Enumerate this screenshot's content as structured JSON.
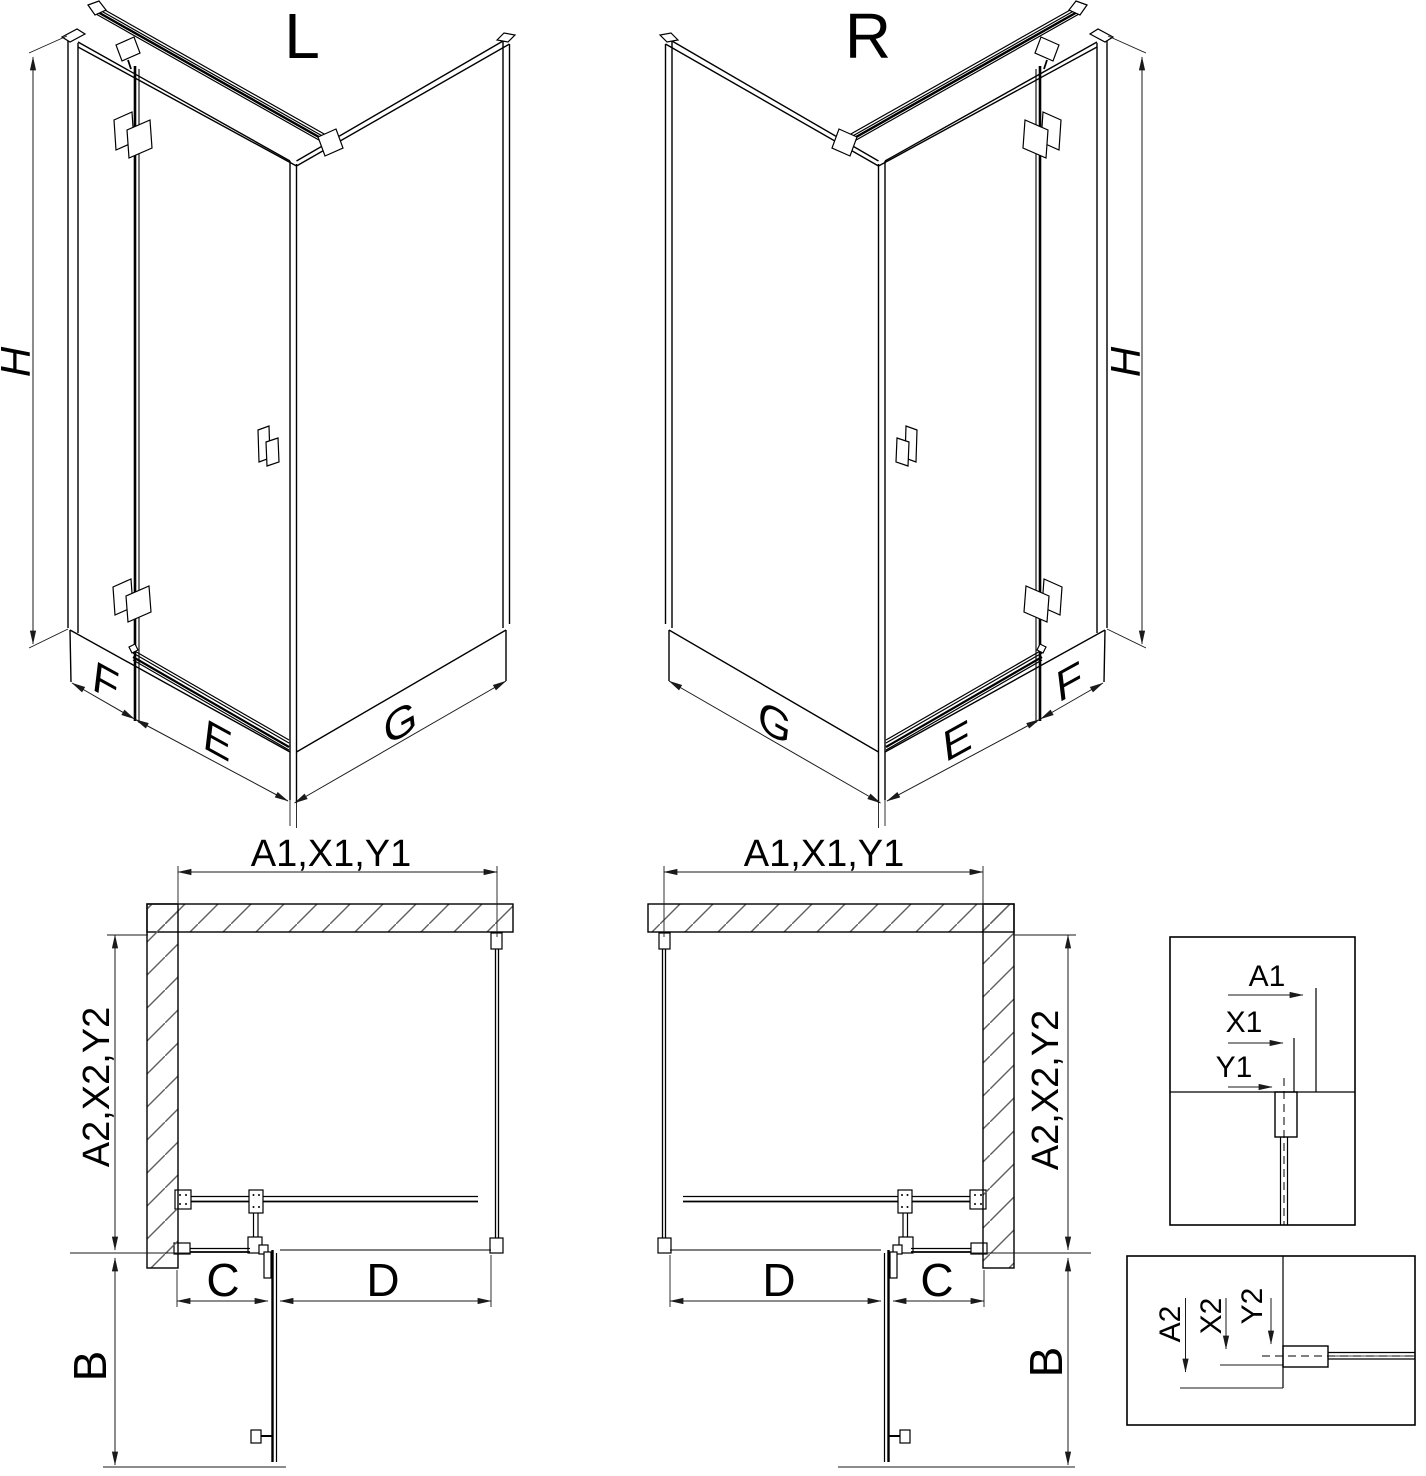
{
  "drawing": {
    "iso_left": {
      "title": "L",
      "height_label": "H",
      "front_fixed_label": "F",
      "front_door_label": "E",
      "side_label": "G"
    },
    "iso_right": {
      "title": "R",
      "height_label": "H",
      "front_fixed_label": "F",
      "front_door_label": "E",
      "side_label": "G"
    },
    "plan_left": {
      "width_label": "A1,X1,Y1",
      "depth_label": "A2,X2,Y2",
      "fixed_segment_label": "C",
      "door_segment_label": "D",
      "door_swing_label": "B"
    },
    "plan_right": {
      "width_label": "A1,X1,Y1",
      "depth_label": "A2,X2,Y2",
      "fixed_segment_label": "C",
      "door_segment_label": "D",
      "door_swing_label": "B"
    },
    "detail_width": {
      "outer": "A1",
      "mid": "X1",
      "inner": "Y1"
    },
    "detail_depth": {
      "outer": "A2",
      "mid": "X2",
      "inner": "Y2"
    }
  },
  "colors": {
    "line": "#000000",
    "dim": "#1a1a1a",
    "hatch": "#606060",
    "background": "#ffffff"
  }
}
